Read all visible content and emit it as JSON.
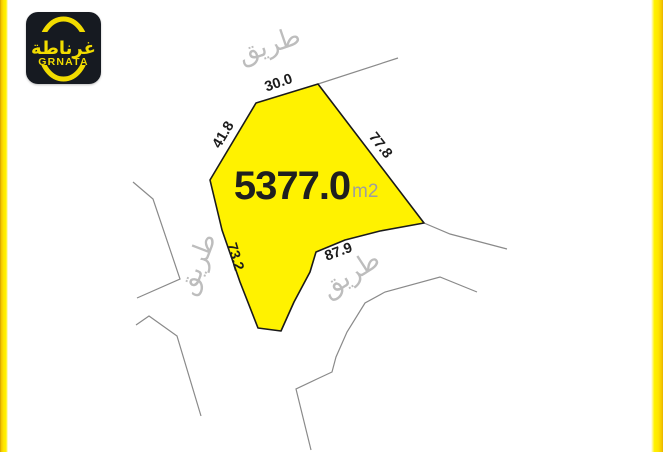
{
  "brand": {
    "arabic": "غرناطة",
    "latin": "GRNATA"
  },
  "parcel": {
    "area": "5377.0",
    "unit": "m2",
    "dim_top": "30.0",
    "dim_upper_left": "41.8",
    "dim_right": "77.8",
    "dim_lower_left": "73.2",
    "dim_bottom": "87.9"
  },
  "roads": {
    "top": "طريق",
    "left": "طريق",
    "bottom": "طريق"
  },
  "colors": {
    "parcel_fill": "#fff200",
    "parcel_stroke": "#1a1a1a",
    "road_line": "#8a8a8a",
    "road_text": "#bdbdbd",
    "area_text": "#1f1f1f",
    "unit_text": "#9e9e9e",
    "accent_yellow": "#ffe600",
    "logo_bg": "#161a21",
    "logo_yellow": "#f2dc00"
  }
}
